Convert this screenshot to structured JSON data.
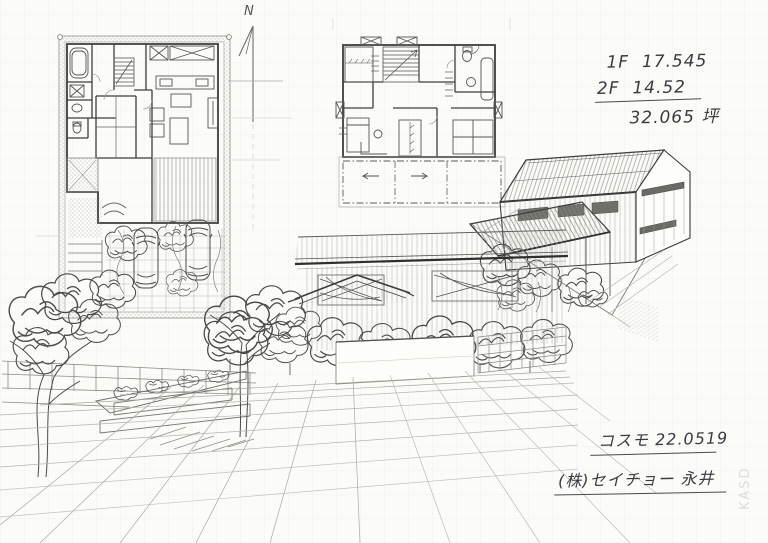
{
  "annotations": {
    "north_label": "N",
    "area_notes": {
      "floor1": "1F  17.545",
      "floor2": "2F  14.52",
      "total": "32.065 坪"
    },
    "footer": {
      "project_code": "コスモ 22.0519",
      "company": "(株)セイチョー 永井"
    },
    "watermark": "KASD"
  },
  "colors": {
    "paper": "#fbfbf8",
    "pencil_dark": "#3d3d3d",
    "pencil_mid": "#6e6e6e",
    "pencil_light": "#a9a9a9",
    "grid_faint": "#b3b3af"
  }
}
